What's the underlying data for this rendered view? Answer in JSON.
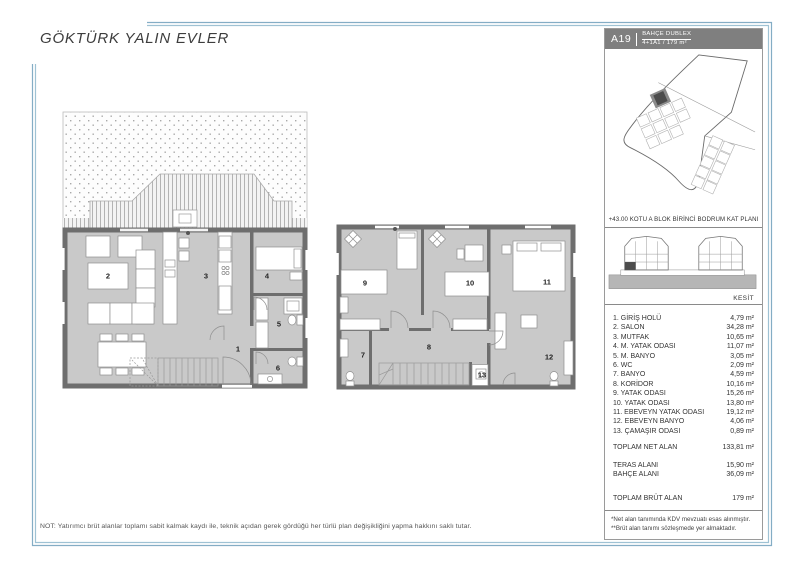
{
  "page": {
    "title": "GÖKTÜRK YALIN EVLER",
    "note": "NOT: Yatırımcı brüt alanlar toplamı sabit kalmak kaydı ile, teknik açıdan gerek gördüğü her türlü plan değişikliğini yapma hakkını saklı tutar."
  },
  "unit_card": {
    "code": "A19",
    "name": "BAHÇE DUBLEX",
    "spec": "4+1A1 / 179 m²",
    "site_caption": "+43.00 KOTU A BLOK BİRİNCİ BODRUM KAT PLANI",
    "section_label": "KESİT",
    "rooms": [
      {
        "no": "1.",
        "name": "GİRİŞ HOLÜ",
        "area": "4,79 m²"
      },
      {
        "no": "2.",
        "name": "SALON",
        "area": "34,28 m²"
      },
      {
        "no": "3.",
        "name": "MUTFAK",
        "area": "10,65 m²"
      },
      {
        "no": "4.",
        "name": "M. YATAK ODASI",
        "area": "11,07 m²"
      },
      {
        "no": "5.",
        "name": "M. BANYO",
        "area": "3,05 m²"
      },
      {
        "no": "6.",
        "name": "WC",
        "area": "2,09 m²"
      },
      {
        "no": "7.",
        "name": "BANYO",
        "area": "4,59 m²"
      },
      {
        "no": "8.",
        "name": "KORİDOR",
        "area": "10,16 m²"
      },
      {
        "no": "9.",
        "name": "YATAK ODASI",
        "area": "15,26 m²"
      },
      {
        "no": "10.",
        "name": "YATAK ODASI",
        "area": "13,80 m²"
      },
      {
        "no": "11.",
        "name": "EBEVEYN YATAK ODASI",
        "area": "19,12 m²"
      },
      {
        "no": "12.",
        "name": "EBEVEYN BANYO",
        "area": "4,06 m²"
      },
      {
        "no": "13.",
        "name": "ÇAMAŞIR ODASI",
        "area": "0,89 m²"
      }
    ],
    "totals": {
      "net": {
        "label": "TOPLAM NET ALAN",
        "value": "133,81 m²"
      },
      "teras": {
        "label": "TERAS ALANI",
        "value": "15,90 m²"
      },
      "bahce": {
        "label": "BAHÇE ALANI",
        "value": "36,09 m²"
      },
      "brut": {
        "label": "TOPLAM BRÜT ALAN",
        "value": "179 m²"
      }
    },
    "footnotes": [
      "*Net alan tanımında KDV mevzuatı esas alınmıştır.",
      "**Brüt alan tanımı sözleşmede yer almaktadır."
    ]
  },
  "plans": {
    "ground_floor": {
      "labels": [
        {
          "text": "1",
          "x": 178,
          "y": 239
        },
        {
          "text": "2",
          "x": 48,
          "y": 166
        },
        {
          "text": "3",
          "x": 146,
          "y": 166
        },
        {
          "text": "4",
          "x": 207,
          "y": 166
        },
        {
          "text": "5",
          "x": 219,
          "y": 214
        },
        {
          "text": "6",
          "x": 218,
          "y": 258
        }
      ]
    },
    "basement_floor": {
      "labels": [
        {
          "text": "7",
          "x": 28,
          "y": 132
        },
        {
          "text": "8",
          "x": 94,
          "y": 124
        },
        {
          "text": "9",
          "x": 30,
          "y": 60
        },
        {
          "text": "10",
          "x": 135,
          "y": 60
        },
        {
          "text": "11",
          "x": 212,
          "y": 59
        },
        {
          "text": "12",
          "x": 214,
          "y": 134
        },
        {
          "text": "13",
          "x": 147,
          "y": 152
        }
      ]
    }
  },
  "colors": {
    "frame_blue": "#84adc5",
    "header_gray": "#7f7f7f",
    "wall_gray": "#6e6e6e",
    "floor_gray": "#c9c9c9",
    "highlight_dark": "#4c4c4c"
  }
}
